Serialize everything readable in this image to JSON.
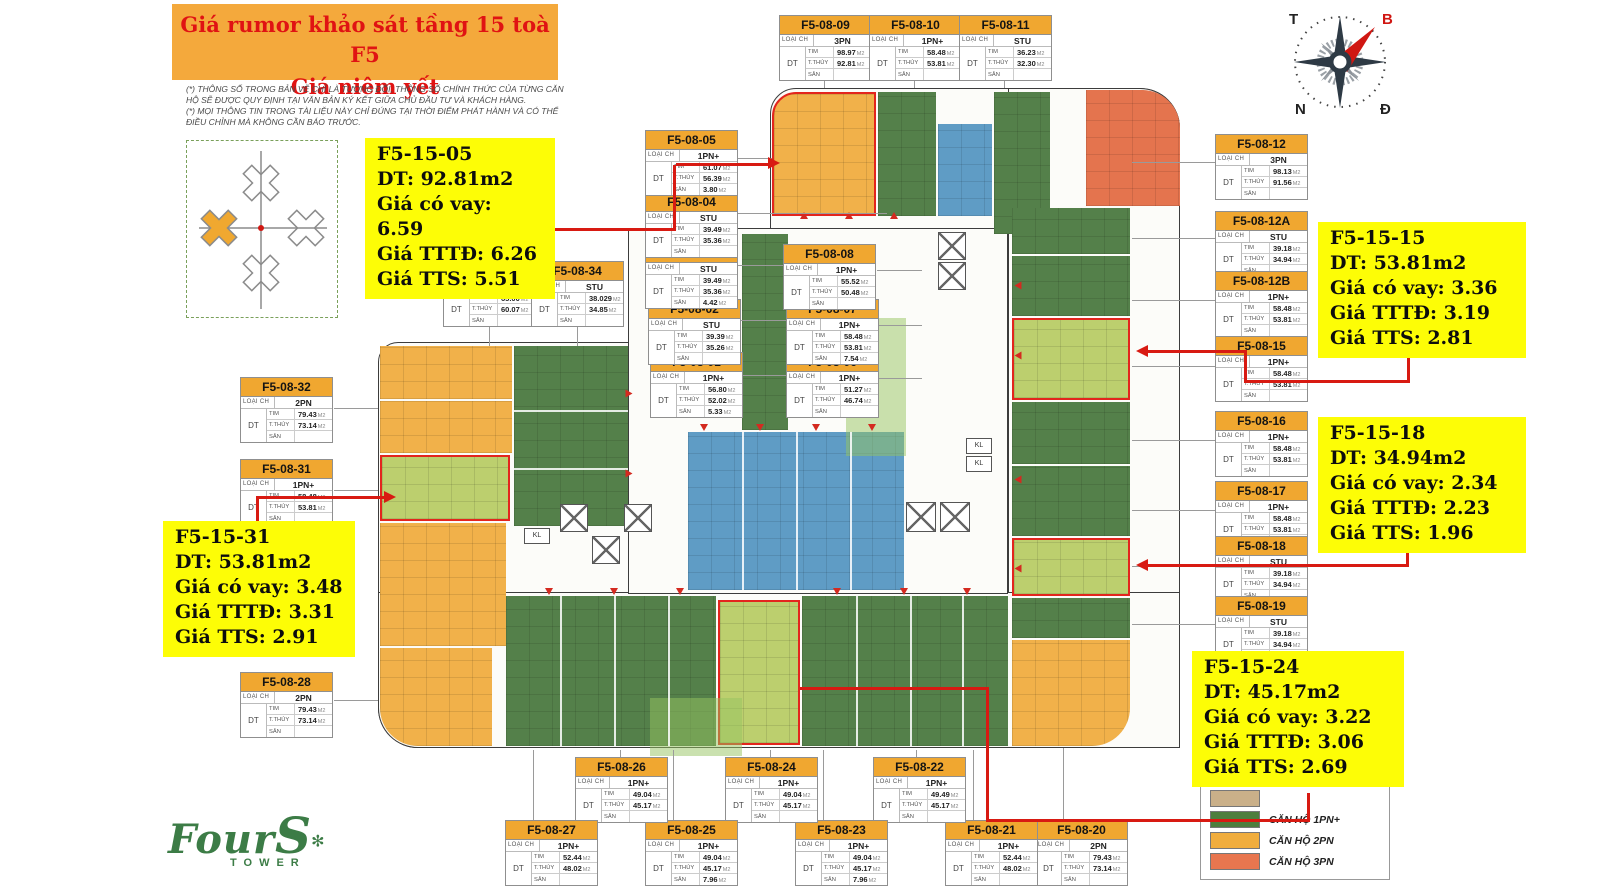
{
  "title": {
    "line1": "Giá rumor khảo sát tầng 15 toà F5",
    "line2": "Giá niêm yết"
  },
  "disclaimer": {
    "p1": "(*) THÔNG SỐ TRONG BẢN VẼ CHỈ LÀ TƯƠNG ĐỐI, THÔNG SỐ CHÍNH THỨC CỦA TỪNG CĂN HỘ SẼ ĐƯỢC QUY ĐỊNH TẠI VĂN BẢN KÝ KẾT GIỮA CHỦ ĐẦU TƯ VÀ KHÁCH HÀNG.",
    "p2": "(*) MỌI THÔNG TIN TRONG TÀI LIỆU NÀY CHỈ ĐÚNG TẠI THỜI ĐIỂM PHÁT HÀNH VÀ CÓ THỂ ĐIỀU CHỈNH MÀ KHÔNG CẦN BÁO TRƯỚC."
  },
  "table_labels": {
    "loai_ch": "LOẠI CH",
    "dt": "DT",
    "tim": "TIM",
    "tthuy": "T.THỦY",
    "san": "SÂN",
    "m2": "M2"
  },
  "units": [
    {
      "id": "F5-08-01",
      "type": "1PN+",
      "tim": "56.80",
      "tthuy": "52.02",
      "san": "5.33"
    },
    {
      "id": "F5-08-02",
      "type": "STU",
      "tim": "39.39",
      "tthuy": "35.26",
      "san": ""
    },
    {
      "id": "F5-08-03",
      "type": "STU",
      "tim": "39.49",
      "tthuy": "35.36",
      "san": "4.42"
    },
    {
      "id": "F5-08-04",
      "type": "STU",
      "tim": "39.49",
      "tthuy": "35.36",
      "san": ""
    },
    {
      "id": "F5-08-05",
      "type": "1PN+",
      "tim": "61.07",
      "tthuy": "56.39",
      "san": "3.80"
    },
    {
      "id": "F5-08-06",
      "type": "1PN+",
      "tim": "51.27",
      "tthuy": "46.74",
      "san": ""
    },
    {
      "id": "F5-08-07",
      "type": "1PN+",
      "tim": "58.48",
      "tthuy": "53.81",
      "san": "7.54"
    },
    {
      "id": "F5-08-08",
      "type": "1PN+",
      "tim": "55.52",
      "tthuy": "50.48",
      "san": ""
    },
    {
      "id": "F5-08-09",
      "type": "3PN",
      "tim": "98.97",
      "tthuy": "92.81",
      "san": ""
    },
    {
      "id": "F5-08-10",
      "type": "1PN+",
      "tim": "58.48",
      "tthuy": "53.81",
      "san": ""
    },
    {
      "id": "F5-08-11",
      "type": "STU",
      "tim": "36.23",
      "tthuy": "32.30",
      "san": ""
    },
    {
      "id": "F5-08-12",
      "type": "3PN",
      "tim": "98.13",
      "tthuy": "91.56",
      "san": ""
    },
    {
      "id": "F5-08-12A",
      "type": "STU",
      "tim": "39.18",
      "tthuy": "34.94",
      "san": ""
    },
    {
      "id": "F5-08-12B",
      "type": "1PN+",
      "tim": "58.48",
      "tthuy": "53.81",
      "san": ""
    },
    {
      "id": "F5-08-15",
      "type": "1PN+",
      "tim": "58.48",
      "tthuy": "53.81",
      "san": ""
    },
    {
      "id": "F5-08-16",
      "type": "1PN+",
      "tim": "58.48",
      "tthuy": "53.81",
      "san": ""
    },
    {
      "id": "F5-08-17",
      "type": "1PN+",
      "tim": "58.48",
      "tthuy": "53.81",
      "san": ""
    },
    {
      "id": "F5-08-18",
      "type": "STU",
      "tim": "39.18",
      "tthuy": "34.94",
      "san": ""
    },
    {
      "id": "F5-08-19",
      "type": "STU",
      "tim": "39.18",
      "tthuy": "34.94",
      "san": ""
    },
    {
      "id": "F5-08-20",
      "type": "2PN",
      "tim": "79.43",
      "tthuy": "73.14",
      "san": ""
    },
    {
      "id": "F5-08-21",
      "type": "1PN+",
      "tim": "52.44",
      "tthuy": "48.02",
      "san": ""
    },
    {
      "id": "F5-08-22",
      "type": "1PN+",
      "tim": "49.49",
      "tthuy": "45.17",
      "san": ""
    },
    {
      "id": "F5-08-23",
      "type": "1PN+",
      "tim": "49.04",
      "tthuy": "45.17",
      "san": "7.96"
    },
    {
      "id": "F5-08-24",
      "type": "1PN+",
      "tim": "49.04",
      "tthuy": "45.17",
      "san": ""
    },
    {
      "id": "F5-08-25",
      "type": "1PN+",
      "tim": "49.04",
      "tthuy": "45.17",
      "san": "7.96"
    },
    {
      "id": "F5-08-26",
      "type": "1PN+",
      "tim": "49.04",
      "tthuy": "45.17",
      "san": ""
    },
    {
      "id": "F5-08-27",
      "type": "1PN+",
      "tim": "52.44",
      "tthuy": "48.02",
      "san": ""
    },
    {
      "id": "F5-08-28",
      "type": "2PN",
      "tim": "79.43",
      "tthuy": "73.14",
      "san": ""
    },
    {
      "id": "F5-08-31",
      "type": "1PN+",
      "tim": "58.48",
      "tthuy": "53.81",
      "san": ""
    },
    {
      "id": "F5-08-32",
      "type": "2PN",
      "tim": "79.43",
      "tthuy": "73.14",
      "san": ""
    },
    {
      "id": "F5-08-33",
      "type": "1PN+",
      "tim": "65.00",
      "tthuy": "60.07",
      "san": ""
    },
    {
      "id": "F5-08-34",
      "type": "STU",
      "tim": "38.029",
      "tthuy": "34.85",
      "san": ""
    }
  ],
  "annotations": [
    {
      "id": "F5-15-05",
      "dt": "DT: 92.81m2",
      "vay": "Giá có vay: 6.59",
      "tttd": "Giá TTTĐ: 6.26",
      "tts": "Giá TTS: 5.51"
    },
    {
      "id": "F5-15-31",
      "dt": "DT: 53.81m2",
      "vay": "Giá có vay: 3.48",
      "tttd": "Giá TTTĐ: 3.31",
      "tts": "Giá TTS: 2.91"
    },
    {
      "id": "F5-15-15",
      "dt": "DT: 53.81m2",
      "vay": "Giá có vay: 3.36",
      "tttd": "Giá TTTĐ: 3.19",
      "tts": "Giá TTS: 2.81"
    },
    {
      "id": "F5-15-18",
      "dt": "DT: 34.94m2",
      "vay": "Giá có vay: 2.34",
      "tttd": "Giá TTTĐ: 2.23",
      "tts": "Giá TTS: 1.96"
    },
    {
      "id": "F5-15-24",
      "dt": "DT: 45.17m2",
      "vay": "Giá có vay: 3.22",
      "tttd": "Giá TTTĐ: 3.06",
      "tts": "Giá TTS: 2.69"
    }
  ],
  "legend": {
    "items": [
      {
        "label": "",
        "color": "#cab089"
      },
      {
        "label": "CĂN HỘ 1PN+",
        "color": "#4e7e3e"
      },
      {
        "label": "CĂN HỘ 2PN",
        "color": "#f0ad3d"
      },
      {
        "label": "CĂN HỘ 3PN",
        "color": "#e8764f"
      }
    ]
  },
  "compass": {
    "west": "T",
    "north": "B",
    "south": "N",
    "east": "Đ"
  },
  "logo": {
    "four": "Four",
    "s": "S",
    "flower": "✻",
    "tower": "TOWER"
  },
  "plan": {
    "kl_label": "KL"
  }
}
